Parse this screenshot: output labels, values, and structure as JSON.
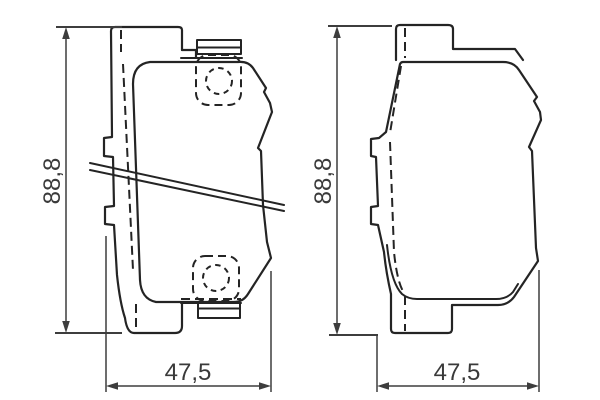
{
  "drawing": {
    "kind": "technical-drawing",
    "subject": "brake-pad-set-two-views",
    "background_color": "#ffffff",
    "line_color": "#242424",
    "dimension_color": "#3d3d3d",
    "views": [
      {
        "id": "left-pad",
        "description": "brake pad with top and bottom shim plates, dashed wear-indicator holes and diagonal sensor wire",
        "height_label": "88,8",
        "width_label": "47,5"
      },
      {
        "id": "right-pad",
        "description": "brake pad back-plate outline view",
        "height_label": "88,8",
        "width_label": "47,5"
      }
    ]
  }
}
